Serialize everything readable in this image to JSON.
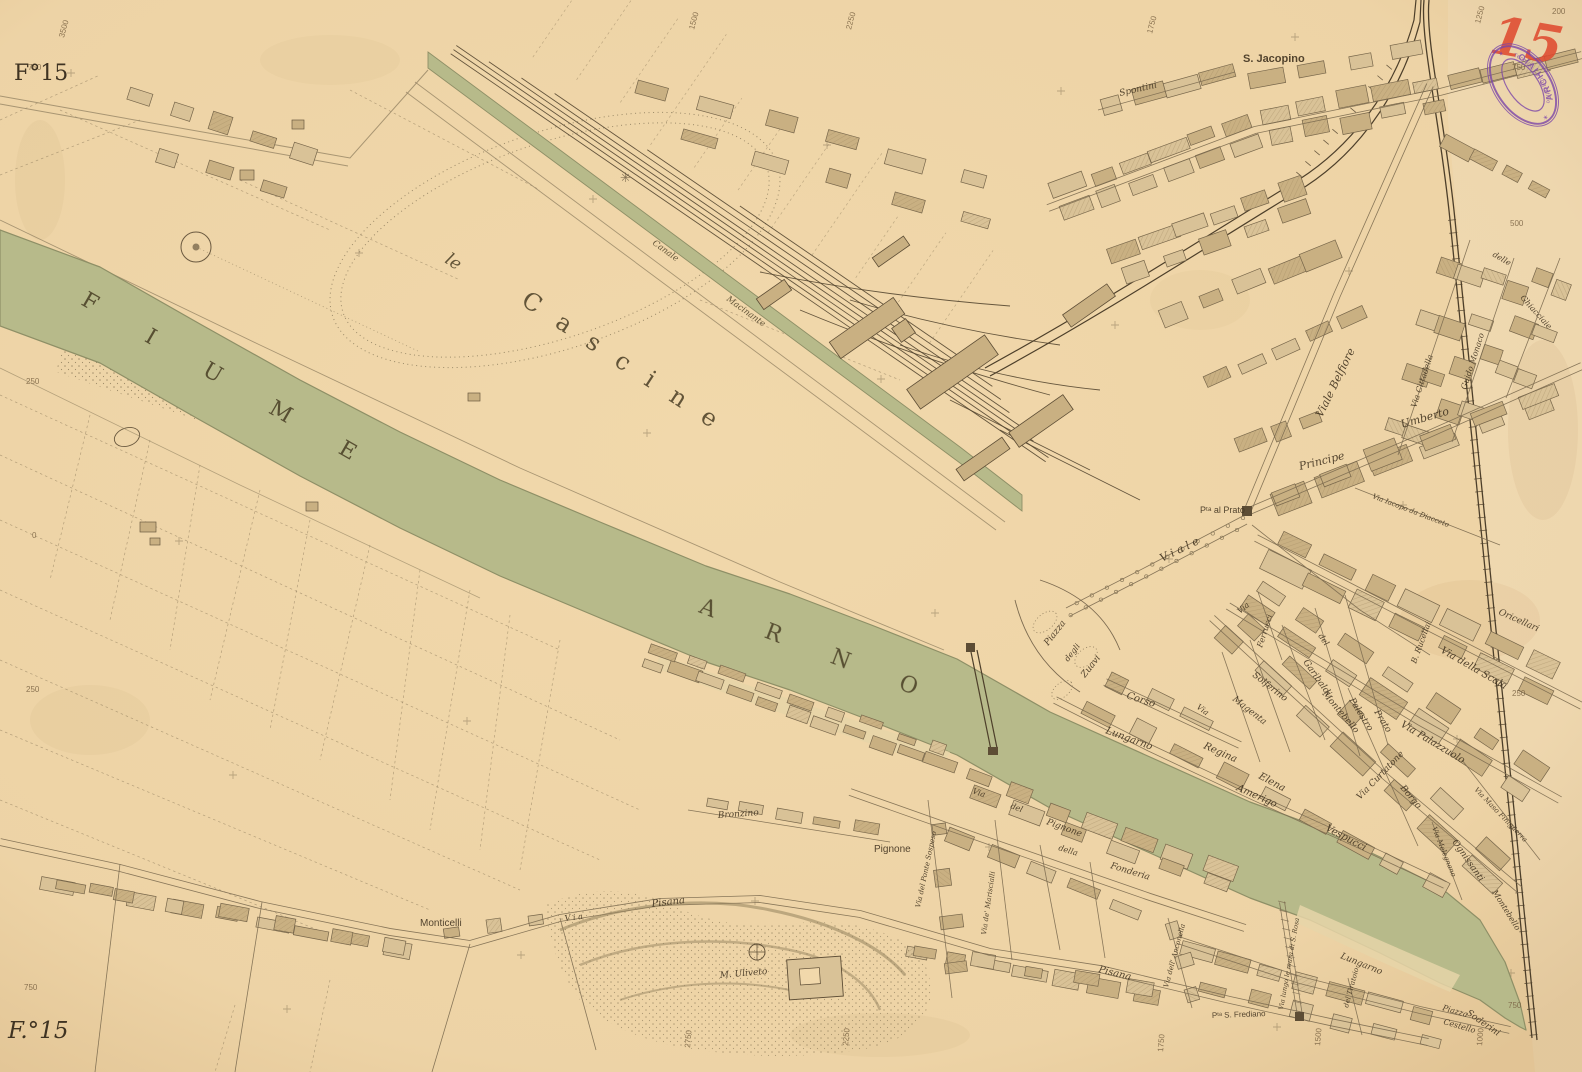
{
  "sheet": {
    "corner_top_left": "F°15",
    "corner_bottom_left": "F.°15",
    "red_number": "15"
  },
  "stamp": {
    "arc_left": "ARCHIVIO",
    "arc_right": "Tecnico Cartografico"
  },
  "water_labels": {
    "river_word_1": "FIUME",
    "river_word_2": "ARNO",
    "park_article": "le",
    "park_name": "Cascine",
    "canal_word_1": "Canale",
    "canal_word_2": "Macinante"
  },
  "place_labels": [
    {
      "t": "S. Jacopino",
      "x": 1243,
      "y": 62,
      "r": 0,
      "s": 11,
      "f": "b"
    },
    {
      "t": "Spontini",
      "x": 1120,
      "y": 96,
      "r": -13,
      "s": 9
    },
    {
      "t": "Viale Belfiore",
      "x": 1322,
      "y": 418,
      "r": -64,
      "s": 11
    },
    {
      "t": "Via Cittadella",
      "x": 1416,
      "y": 408,
      "r": -72,
      "s": 8
    },
    {
      "t": "Guido Monaco",
      "x": 1466,
      "y": 390,
      "r": -72,
      "s": 8
    },
    {
      "t": "delle",
      "x": 1492,
      "y": 256,
      "r": 30,
      "s": 8
    },
    {
      "t": "Ghiacciaie",
      "x": 1520,
      "y": 298,
      "r": 48,
      "s": 8
    },
    {
      "t": "Principe",
      "x": 1300,
      "y": 470,
      "r": -14,
      "s": 11
    },
    {
      "t": "Umberto",
      "x": 1402,
      "y": 428,
      "r": -16,
      "s": 11
    },
    {
      "t": "Via Iacopo da Diacceto",
      "x": 1372,
      "y": 498,
      "r": 21,
      "s": 7
    },
    {
      "t": "Pᵗᵃ al Prato",
      "x": 1200,
      "y": 513,
      "r": 0,
      "s": 9,
      "f": "u"
    },
    {
      "t": "V i a l e",
      "x": 1162,
      "y": 562,
      "r": -26,
      "s": 11
    },
    {
      "t": "Piazza",
      "x": 1048,
      "y": 646,
      "r": -52,
      "s": 9
    },
    {
      "t": "degli",
      "x": 1068,
      "y": 662,
      "r": -52,
      "s": 8
    },
    {
      "t": "Zuavi",
      "x": 1085,
      "y": 678,
      "r": -52,
      "s": 9
    },
    {
      "t": "Corso",
      "x": 1126,
      "y": 698,
      "r": 18,
      "s": 10
    },
    {
      "t": "Lungarno",
      "x": 1105,
      "y": 733,
      "r": 20,
      "s": 10
    },
    {
      "t": "Regina",
      "x": 1203,
      "y": 748,
      "r": 24,
      "s": 10
    },
    {
      "t": "Elena",
      "x": 1258,
      "y": 778,
      "r": 28,
      "s": 10
    },
    {
      "t": "Amerigo",
      "x": 1236,
      "y": 790,
      "r": 24,
      "s": 10
    },
    {
      "t": "Vespucci",
      "x": 1325,
      "y": 830,
      "r": 28,
      "s": 10
    },
    {
      "t": "Via",
      "x": 1196,
      "y": 708,
      "r": 36,
      "s": 8
    },
    {
      "t": "Magenta",
      "x": 1232,
      "y": 700,
      "r": 38,
      "s": 9
    },
    {
      "t": "Solferino",
      "x": 1252,
      "y": 676,
      "r": 38,
      "s": 9
    },
    {
      "t": "Garibaldi",
      "x": 1303,
      "y": 662,
      "r": 55,
      "s": 9
    },
    {
      "t": "Montebello",
      "x": 1322,
      "y": 694,
      "r": 50,
      "s": 9
    },
    {
      "t": "Palestro",
      "x": 1349,
      "y": 700,
      "r": 58,
      "s": 9
    },
    {
      "t": "Prato",
      "x": 1374,
      "y": 712,
      "r": 58,
      "s": 9
    },
    {
      "t": "Via Curtatone",
      "x": 1360,
      "y": 800,
      "r": -46,
      "s": 9
    },
    {
      "t": "Borgo",
      "x": 1400,
      "y": 788,
      "r": 50,
      "s": 9
    },
    {
      "t": "Ognissanti",
      "x": 1452,
      "y": 842,
      "r": 55,
      "s": 9
    },
    {
      "t": "Montebello",
      "x": 1492,
      "y": 892,
      "r": 58,
      "s": 8
    },
    {
      "t": "Via Melegnano",
      "x": 1432,
      "y": 828,
      "r": 68,
      "s": 7
    },
    {
      "t": "Via Maso Finiguerra",
      "x": 1474,
      "y": 790,
      "r": 46,
      "s": 7
    },
    {
      "t": "Via Palazzuolo",
      "x": 1400,
      "y": 726,
      "r": 31,
      "s": 10
    },
    {
      "t": "Via della Scala",
      "x": 1440,
      "y": 652,
      "r": 30,
      "s": 10
    },
    {
      "t": "Oricellari",
      "x": 1498,
      "y": 614,
      "r": 24,
      "s": 9
    },
    {
      "t": "B. Rucellai",
      "x": 1416,
      "y": 664,
      "r": -70,
      "s": 8
    },
    {
      "t": "Via",
      "x": 1240,
      "y": 614,
      "r": -40,
      "s": 8
    },
    {
      "t": "Ferrucci",
      "x": 1262,
      "y": 648,
      "r": -72,
      "s": 8
    },
    {
      "t": "del",
      "x": 1318,
      "y": 636,
      "r": 55,
      "s": 8
    },
    {
      "t": "della",
      "x": 1058,
      "y": 850,
      "r": 17,
      "s": 8
    },
    {
      "t": "Fonderia",
      "x": 1110,
      "y": 868,
      "r": 17,
      "s": 9
    },
    {
      "t": "Via",
      "x": 972,
      "y": 793,
      "r": 20,
      "s": 8
    },
    {
      "t": "del",
      "x": 1010,
      "y": 808,
      "r": 20,
      "s": 8
    },
    {
      "t": "Pignone",
      "x": 1046,
      "y": 824,
      "r": 20,
      "s": 9
    },
    {
      "t": "Pignone",
      "x": 874,
      "y": 852,
      "r": 0,
      "s": 10,
      "f": "u"
    },
    {
      "t": "Via del Ponte Sospeso",
      "x": 920,
      "y": 908,
      "r": -78,
      "s": 7
    },
    {
      "t": "Via de' Mariscialli",
      "x": 986,
      "y": 935,
      "r": -82,
      "s": 7
    },
    {
      "t": "Bronzino",
      "x": 718,
      "y": 818,
      "r": -4,
      "s": 9
    },
    {
      "t": "V i a",
      "x": 565,
      "y": 921,
      "r": -7,
      "s": 8
    },
    {
      "t": "Pisana",
      "x": 652,
      "y": 907,
      "r": -7,
      "s": 10
    },
    {
      "t": "Pisana",
      "x": 1098,
      "y": 972,
      "r": 14,
      "s": 10
    },
    {
      "t": "Monticelli",
      "x": 420,
      "y": 926,
      "r": 0,
      "s": 10,
      "f": "u"
    },
    {
      "t": "M. Uliveto",
      "x": 720,
      "y": 978,
      "r": -5,
      "s": 9
    },
    {
      "t": "Via dell' Anconella",
      "x": 1168,
      "y": 988,
      "r": -75,
      "s": 7
    },
    {
      "t": "Pᵗᵃ S. Frediano",
      "x": 1212,
      "y": 1018,
      "r": -2,
      "s": 8,
      "f": "u"
    },
    {
      "t": "Via lungo le mura di S. Rosa",
      "x": 1283,
      "y": 1010,
      "r": -80,
      "s": 6.5
    },
    {
      "t": "Lungarno",
      "x": 1340,
      "y": 958,
      "r": 22,
      "s": 9
    },
    {
      "t": "del Tiratoio",
      "x": 1348,
      "y": 1008,
      "r": -75,
      "s": 7
    },
    {
      "t": "Piazza",
      "x": 1442,
      "y": 1010,
      "r": 16,
      "s": 8
    },
    {
      "t": "Cestello",
      "x": 1443,
      "y": 1024,
      "r": 16,
      "s": 8
    },
    {
      "t": "Soderini",
      "x": 1466,
      "y": 1014,
      "r": 35,
      "s": 9
    }
  ],
  "grid_numbers": [
    {
      "t": "3500",
      "x": 64,
      "y": 38,
      "r": -75
    },
    {
      "t": "1500",
      "x": 694,
      "y": 30,
      "r": -75
    },
    {
      "t": "2250",
      "x": 851,
      "y": 30,
      "r": -75
    },
    {
      "t": "1750",
      "x": 1152,
      "y": 34,
      "r": -75
    },
    {
      "t": "1250",
      "x": 1480,
      "y": 24,
      "r": -75
    },
    {
      "t": "200",
      "x": 1552,
      "y": 14,
      "r": 0
    },
    {
      "t": "750",
      "x": 1512,
      "y": 70,
      "r": 0
    },
    {
      "t": "750",
      "x": 28,
      "y": 70,
      "r": 0
    },
    {
      "t": "250",
      "x": 26,
      "y": 384,
      "r": 0
    },
    {
      "t": "0",
      "x": 32,
      "y": 538,
      "r": 0
    },
    {
      "t": "250",
      "x": 26,
      "y": 692,
      "r": 0
    },
    {
      "t": "750",
      "x": 24,
      "y": 990,
      "r": 0
    },
    {
      "t": "2750",
      "x": 690,
      "y": 1048,
      "r": -85
    },
    {
      "t": "2250",
      "x": 848,
      "y": 1046,
      "r": -85
    },
    {
      "t": "1750",
      "x": 1163,
      "y": 1052,
      "r": -85
    },
    {
      "t": "1500",
      "x": 1320,
      "y": 1046,
      "r": -85
    },
    {
      "t": "1000",
      "x": 1482,
      "y": 1046,
      "r": -85
    },
    {
      "t": "750",
      "x": 1508,
      "y": 1008,
      "r": 0
    },
    {
      "t": "500",
      "x": 1510,
      "y": 226,
      "r": 0
    },
    {
      "t": "250",
      "x": 1512,
      "y": 696,
      "r": 0
    }
  ],
  "colors": {
    "paper": "#f1d8ab",
    "water": "#b7ba8a",
    "block": "#d9c297",
    "ink": "#6b5a40",
    "red_mark": "#df4b30",
    "stamp_purple": "#7a44a8"
  }
}
